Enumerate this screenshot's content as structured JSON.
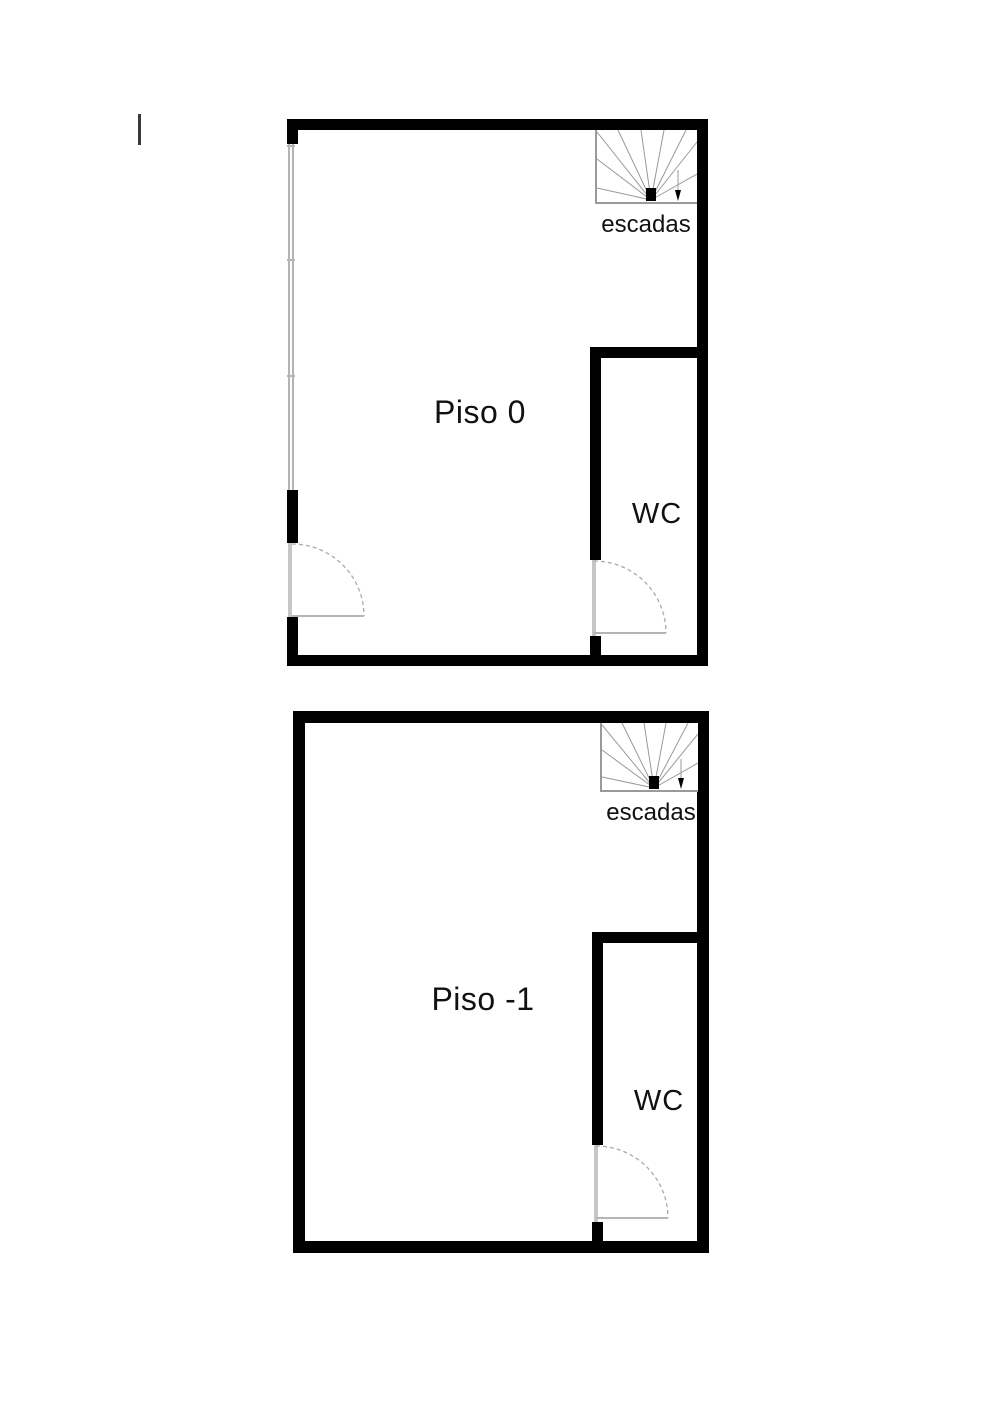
{
  "diagram_type": "floor-plan",
  "colors": {
    "wall": "#000000",
    "stairs_line": "#999999",
    "door_line": "#b5b5b5",
    "window_line": "#b3b3b3",
    "text": "#111111",
    "background": "#ffffff"
  },
  "floors": [
    {
      "label": "Piso 0",
      "wc_label": "WC",
      "stairs_label": "escadas"
    },
    {
      "label": "Piso -1",
      "wc_label": "WC",
      "stairs_label": "escadas"
    }
  ]
}
